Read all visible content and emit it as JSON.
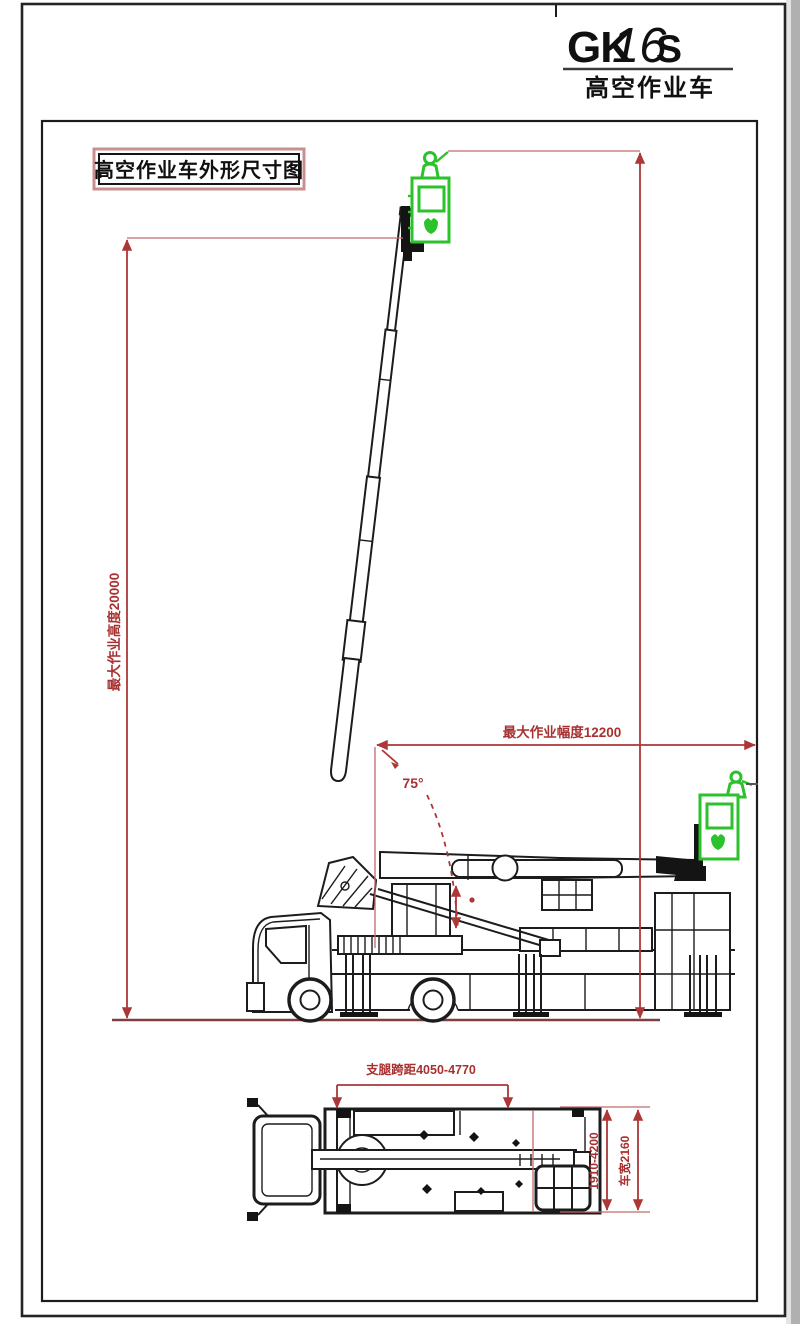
{
  "title": {
    "model_prefix": "GK",
    "model_number": "16",
    "model_suffix": "S",
    "subtitle": "高空作业车"
  },
  "label_box": {
    "text": "高空作业车外形尺寸图"
  },
  "side_view": {
    "dim_max_height": "最大作业高度20000",
    "dim_max_reach": "最大作业幅度12200",
    "boom_angle": "75°"
  },
  "top_view": {
    "dim_outrigger_span": "支腿跨距4050-4770",
    "dim_lateral_span": "1910-4200",
    "dim_vehicle_width": "车宽2160"
  },
  "colors": {
    "line_black": "#1c1c1c",
    "dimension_red": "#ac3737",
    "basket_green": "#2cc22c",
    "ground_maroon": "#7d4040",
    "label_box_pink": "#c98f8f",
    "scan_edge_gray": "#b0b0b0"
  }
}
